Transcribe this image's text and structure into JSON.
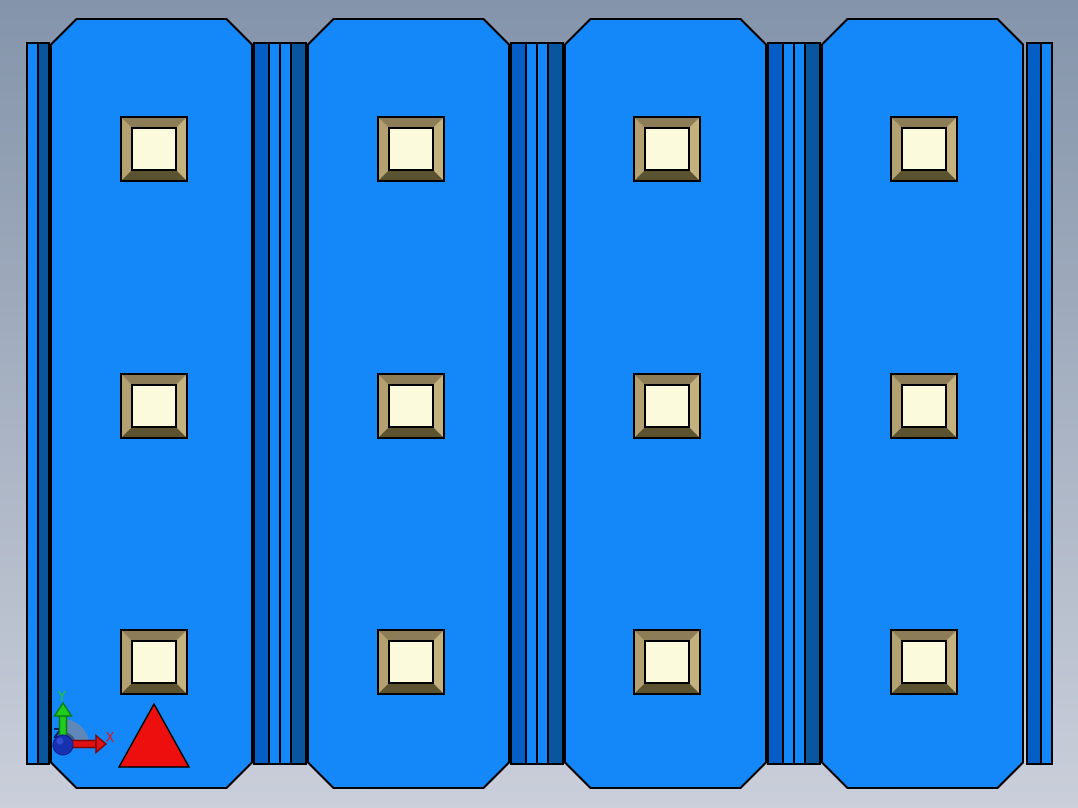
{
  "scene": {
    "background": {
      "top": "#8494AA",
      "bottom": "#CACFDA"
    },
    "part": {
      "x": 26,
      "width": 1026,
      "panel_top": 18,
      "panel_height": 771,
      "chamfer": 26,
      "groove_top": 42,
      "groove_height": 723,
      "colors": {
        "face": "#1488F8",
        "side_lit": "#055DC6",
        "side_shaded": "#0A569E",
        "outline": "#000000"
      },
      "panels": [
        {
          "x": 24,
          "w": 203
        },
        {
          "x": 281,
          "w": 203
        },
        {
          "x": 538,
          "w": 203
        },
        {
          "x": 795,
          "w": 203
        }
      ],
      "grooves_x": [
        227,
        484,
        741
      ],
      "groove_stripes": [
        {
          "w": 2,
          "c": "outline"
        },
        {
          "w": 13,
          "c": "side_lit"
        },
        {
          "w": 2,
          "c": "outline"
        },
        {
          "w": 9,
          "c": "face"
        },
        {
          "w": 2,
          "c": "outline"
        },
        {
          "w": 9,
          "c": "face"
        },
        {
          "w": 2,
          "c": "outline"
        },
        {
          "w": 13,
          "c": "side_shaded"
        },
        {
          "w": 2,
          "c": "outline"
        }
      ],
      "left_edge": {
        "x": 0,
        "stripes": [
          {
            "w": 2,
            "c": "outline"
          },
          {
            "w": 9,
            "c": "face"
          },
          {
            "w": 2,
            "c": "outline"
          },
          {
            "w": 9,
            "c": "side_shaded"
          },
          {
            "w": 2,
            "c": "outline"
          }
        ]
      },
      "right_edge": {
        "x": 1000,
        "stripes": [
          {
            "w": 2,
            "c": "outline"
          },
          {
            "w": 12,
            "c": "side_lit"
          },
          {
            "w": 2,
            "c": "outline"
          },
          {
            "w": 9,
            "c": "face"
          },
          {
            "w": 2,
            "c": "outline"
          }
        ]
      }
    },
    "bosses": {
      "centers_x": [
        128,
        385,
        641,
        898
      ],
      "centers_y": [
        149,
        406,
        662
      ],
      "outer_w": 68,
      "outer_h": 66,
      "colors": {
        "outline": "#000000",
        "top": "#8C7D58",
        "right": "#C4B27E",
        "bottom": "#5B5330",
        "left": "#B3A171",
        "face": "#FCFADC"
      }
    },
    "triad": {
      "arc": {
        "outer_color": "#6C88AD",
        "inner_color": "#31547E"
      },
      "x_axis": {
        "label": "X",
        "color": "#E11212",
        "dark": "#7E0909"
      },
      "y_axis": {
        "label": "Y",
        "color": "#1FCC1F",
        "dark": "#0B7D0B"
      },
      "z_axis": {
        "label": "Z",
        "label_color": "#0A1A60",
        "sphere_color": "#1531B2",
        "sphere_dark": "#0A1C86",
        "sphere_highlight": "#4A63E8"
      }
    },
    "cursor_triangle": {
      "points_str": "154,704 119,767 189,767",
      "color": "#ED0E0E",
      "outline": "#000000"
    }
  }
}
